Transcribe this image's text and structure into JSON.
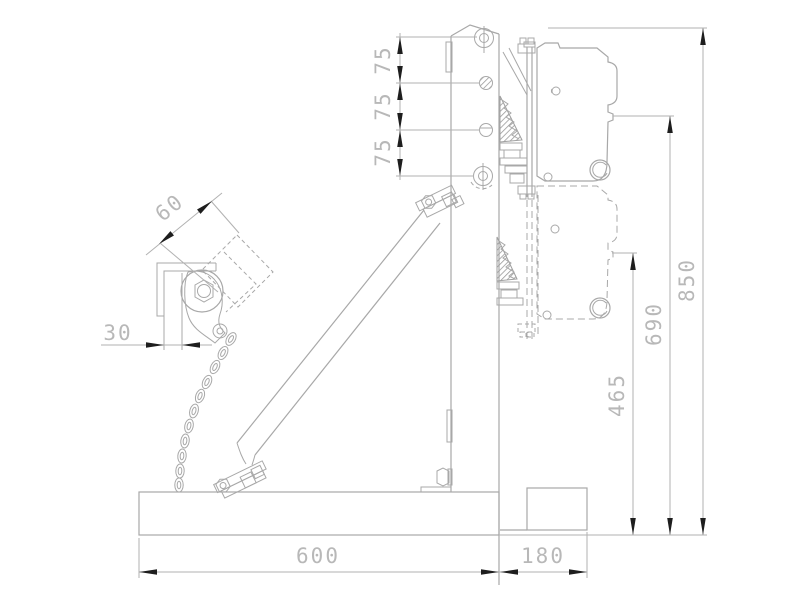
{
  "drawing": {
    "colors": {
      "bg": "#ffffff",
      "line": "#a8a8a8",
      "dim": "#b2b2b2",
      "arrow": "#1e1e1e",
      "text": "#b8b8b8"
    },
    "dimensions": {
      "d75a": "75",
      "d75b": "75",
      "d75c": "75",
      "d60": "60",
      "d30": "30",
      "d465": "465",
      "d690": "690",
      "d850": "850",
      "d600": "600",
      "d180": "180"
    }
  }
}
